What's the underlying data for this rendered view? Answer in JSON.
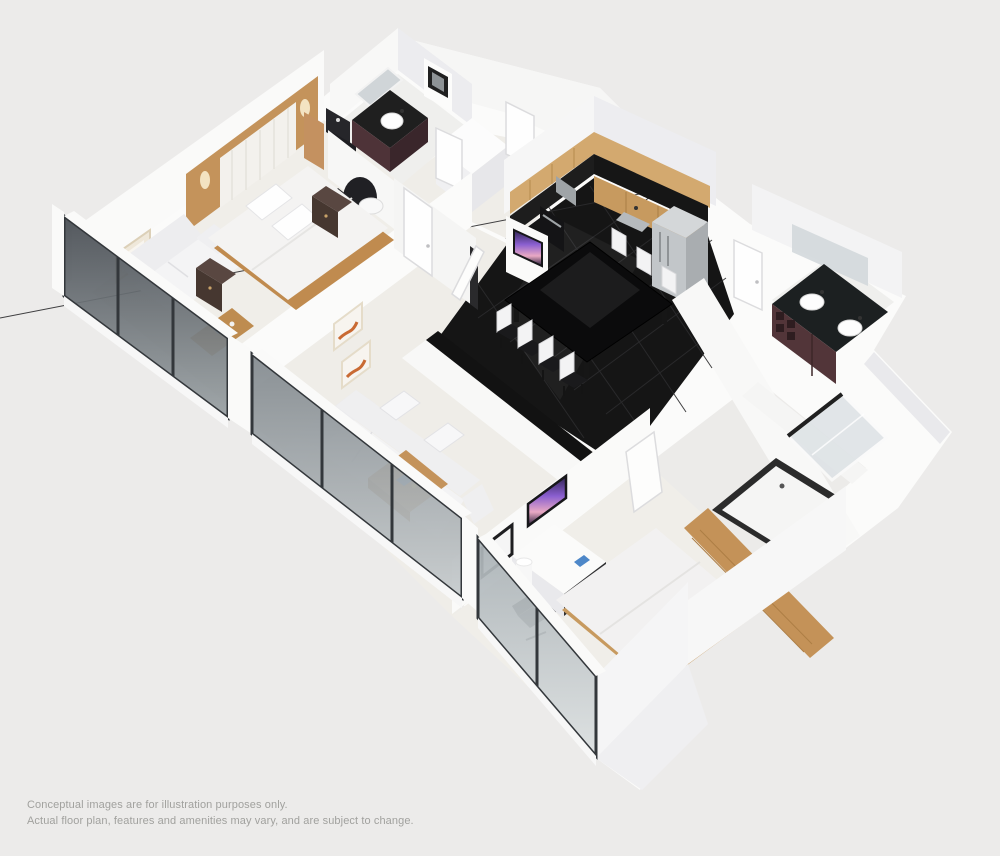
{
  "scene": {
    "description": "3D isometric cutaway rendering of a two-bedroom apartment floor plan",
    "view": "isometric cutaway from south-east above"
  },
  "palette": {
    "background": "#ECEBEA",
    "wall_white": "#F9F9F8",
    "wall_shade": "#E9E9EC",
    "floor_cream": "#F0EEE9",
    "kitchen_floor": "#151515",
    "wood": "#C4935B",
    "cabinet_wood": "#D3A96F",
    "counter_black": "#1D1D1D",
    "vanity_maroon": "#523539",
    "stainless": "#C2C6C9",
    "upholstery": "#F3F3F4",
    "glass_dark": "#474C52",
    "tv_purple": "#8A5FD0",
    "art_orange": "#C96A33",
    "text_gray": "#A1A19E"
  },
  "disclaimer": {
    "line1": "Conceptual images are for illustration purposes only.",
    "line2": "Actual floor plan, features and amenities may vary, and are subject to change."
  },
  "floorplan": {
    "rooms": [
      {
        "name": "master bedroom",
        "items": [
          "bed",
          "wood headboard wall",
          "nightstand",
          "nightstand",
          "loveseat",
          "bench",
          "framed art"
        ]
      },
      {
        "name": "master bathroom",
        "items": [
          "vanity sink",
          "mirror",
          "toilet",
          "stacked washer dryer",
          "wall cabinet"
        ]
      },
      {
        "name": "living room",
        "items": [
          "sectional sofa",
          "coffee table",
          "wall art",
          "wall art",
          "half wall console"
        ]
      },
      {
        "name": "kitchen dining",
        "items": [
          "upper cabinets",
          "black countertop",
          "wall oven",
          "sink",
          "refrigerator",
          "dining table",
          "seven chairs",
          "wall tv"
        ]
      },
      {
        "name": "powder bathroom",
        "items": [
          "double sink vanity",
          "mirror"
        ]
      },
      {
        "name": "second bathroom",
        "items": [
          "bathtub",
          "glass shower"
        ]
      },
      {
        "name": "second bedroom",
        "items": [
          "bed",
          "dresser desk",
          "wall tv",
          "office chair",
          "table lamp",
          "framed art",
          "wood console"
        ]
      },
      {
        "name": "hallway",
        "items": [
          "doors",
          "tv column",
          "closet"
        ]
      }
    ],
    "exterior": "floor-to-ceiling window walls along south and west sides"
  }
}
